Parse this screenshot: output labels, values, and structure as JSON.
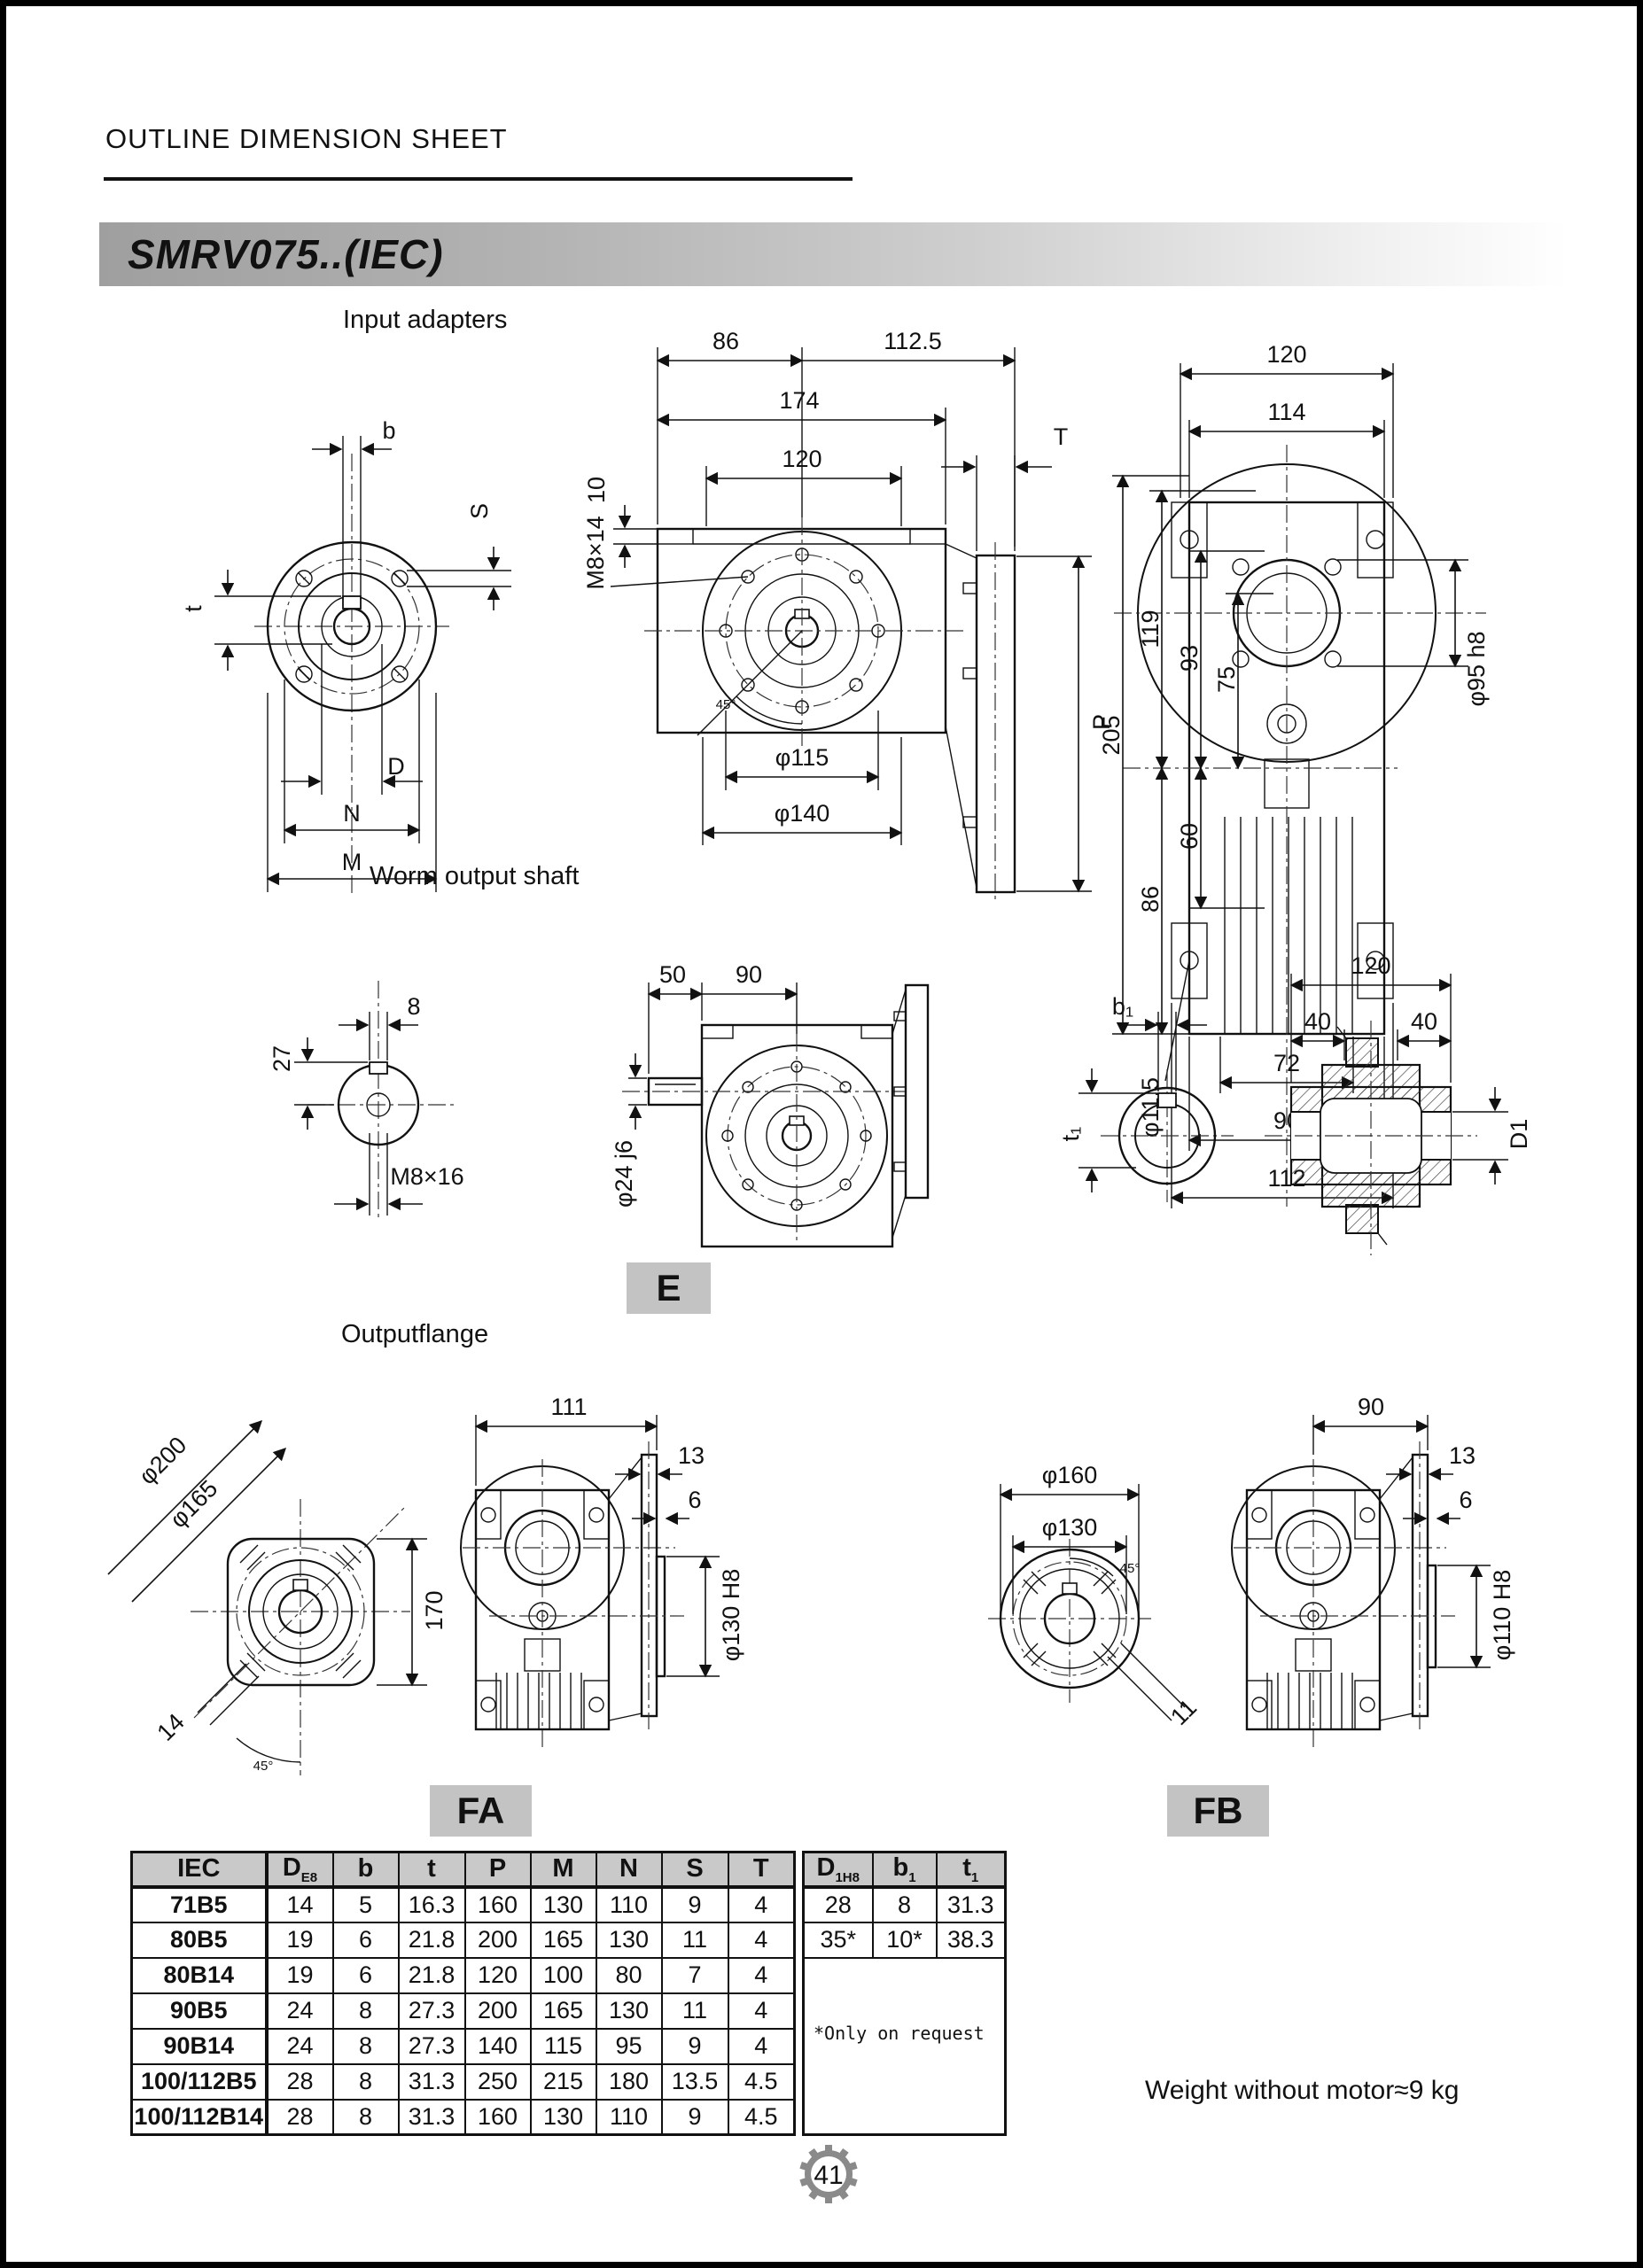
{
  "page": {
    "header_title": "OUTLINE DIMENSION SHEET",
    "model": "SMRV075..(IEC)",
    "weight_note": "Weight without motor≈9 kg",
    "page_number": "41"
  },
  "sections": {
    "input_adapters": {
      "title": "Input adapters",
      "front": {
        "b": "b",
        "S": "S",
        "t": "t",
        "D": "D",
        "N": "N",
        "M": "M"
      },
      "side": {
        "d86": "86",
        "d112_5": "112.5",
        "d174": "174",
        "d120": "120",
        "d10": "10",
        "m8x14": "M8×14",
        "T": "T",
        "P": "P",
        "phi115": "φ115",
        "phi140": "φ140",
        "a45": "45°"
      },
      "back": {
        "d120": "120",
        "d114": "114",
        "d205": "205",
        "d119": "119",
        "d93": "93",
        "d75": "75",
        "d86": "86",
        "d60": "60",
        "phi11_5": "φ11.5",
        "phi95": "φ95 h8",
        "d72": "72",
        "d90": "90",
        "d112": "112"
      }
    },
    "worm_output_shaft": {
      "title": "Worm output shaft",
      "end": {
        "d8": "8",
        "d27": "27",
        "m8x16": "M8×16"
      },
      "side": {
        "d50": "50",
        "d90": "90",
        "phi24": "φ24 j6",
        "label": "E"
      },
      "hollow": {
        "b1": "b₁",
        "t1": "t₁",
        "d120": "120",
        "d40a": "40",
        "d40b": "40",
        "D1": "D1"
      }
    },
    "output_flange": {
      "title": "Outputflange",
      "fa_front": {
        "phi200": "φ200",
        "phi165": "φ165",
        "d170": "170",
        "d14": "14",
        "a45": "45°"
      },
      "fa_side": {
        "d111": "111",
        "d13": "13",
        "d6": "6",
        "phi130": "φ130  H8",
        "label": "FA"
      },
      "fb_front": {
        "phi160": "φ160",
        "phi130": "φ130",
        "d11": "11",
        "a45": "45°"
      },
      "fb_side": {
        "d90": "90",
        "d13": "13",
        "d6": "6",
        "phi110": "φ110  H8",
        "label": "FB"
      }
    }
  },
  "table": {
    "left": {
      "col0_header": "IEC",
      "headers": [
        {
          "m": "D",
          "s": "E8"
        },
        {
          "m": "b",
          "s": ""
        },
        {
          "m": "t",
          "s": ""
        },
        {
          "m": "P",
          "s": ""
        },
        {
          "m": "M",
          "s": ""
        },
        {
          "m": "N",
          "s": ""
        },
        {
          "m": "S",
          "s": ""
        },
        {
          "m": "T",
          "s": ""
        }
      ],
      "rows": [
        {
          "iec": "71B5",
          "vals": [
            "14",
            "5",
            "16.3",
            "160",
            "130",
            "110",
            "9",
            "4"
          ]
        },
        {
          "iec": "80B5",
          "vals": [
            "19",
            "6",
            "21.8",
            "200",
            "165",
            "130",
            "11",
            "4"
          ]
        },
        {
          "iec": "80B14",
          "vals": [
            "19",
            "6",
            "21.8",
            "120",
            "100",
            "80",
            "7",
            "4"
          ]
        },
        {
          "iec": "90B5",
          "vals": [
            "24",
            "8",
            "27.3",
            "200",
            "165",
            "130",
            "11",
            "4"
          ]
        },
        {
          "iec": "90B14",
          "vals": [
            "24",
            "8",
            "27.3",
            "140",
            "115",
            "95",
            "9",
            "4"
          ]
        },
        {
          "iec": "100/112B5",
          "vals": [
            "28",
            "8",
            "31.3",
            "250",
            "215",
            "180",
            "13.5",
            "4.5"
          ]
        },
        {
          "iec": "100/112B14",
          "vals": [
            "28",
            "8",
            "31.3",
            "160",
            "130",
            "110",
            "9",
            "4.5"
          ]
        }
      ]
    },
    "right": {
      "headers": [
        {
          "m": "D",
          "s": "1H8"
        },
        {
          "m": "b",
          "s": "1"
        },
        {
          "m": "t",
          "s": "1"
        }
      ],
      "rows": [
        [
          "28",
          "8",
          "31.3"
        ],
        [
          "35*",
          "10*",
          "38.3"
        ]
      ],
      "note": "*Only on request"
    }
  }
}
